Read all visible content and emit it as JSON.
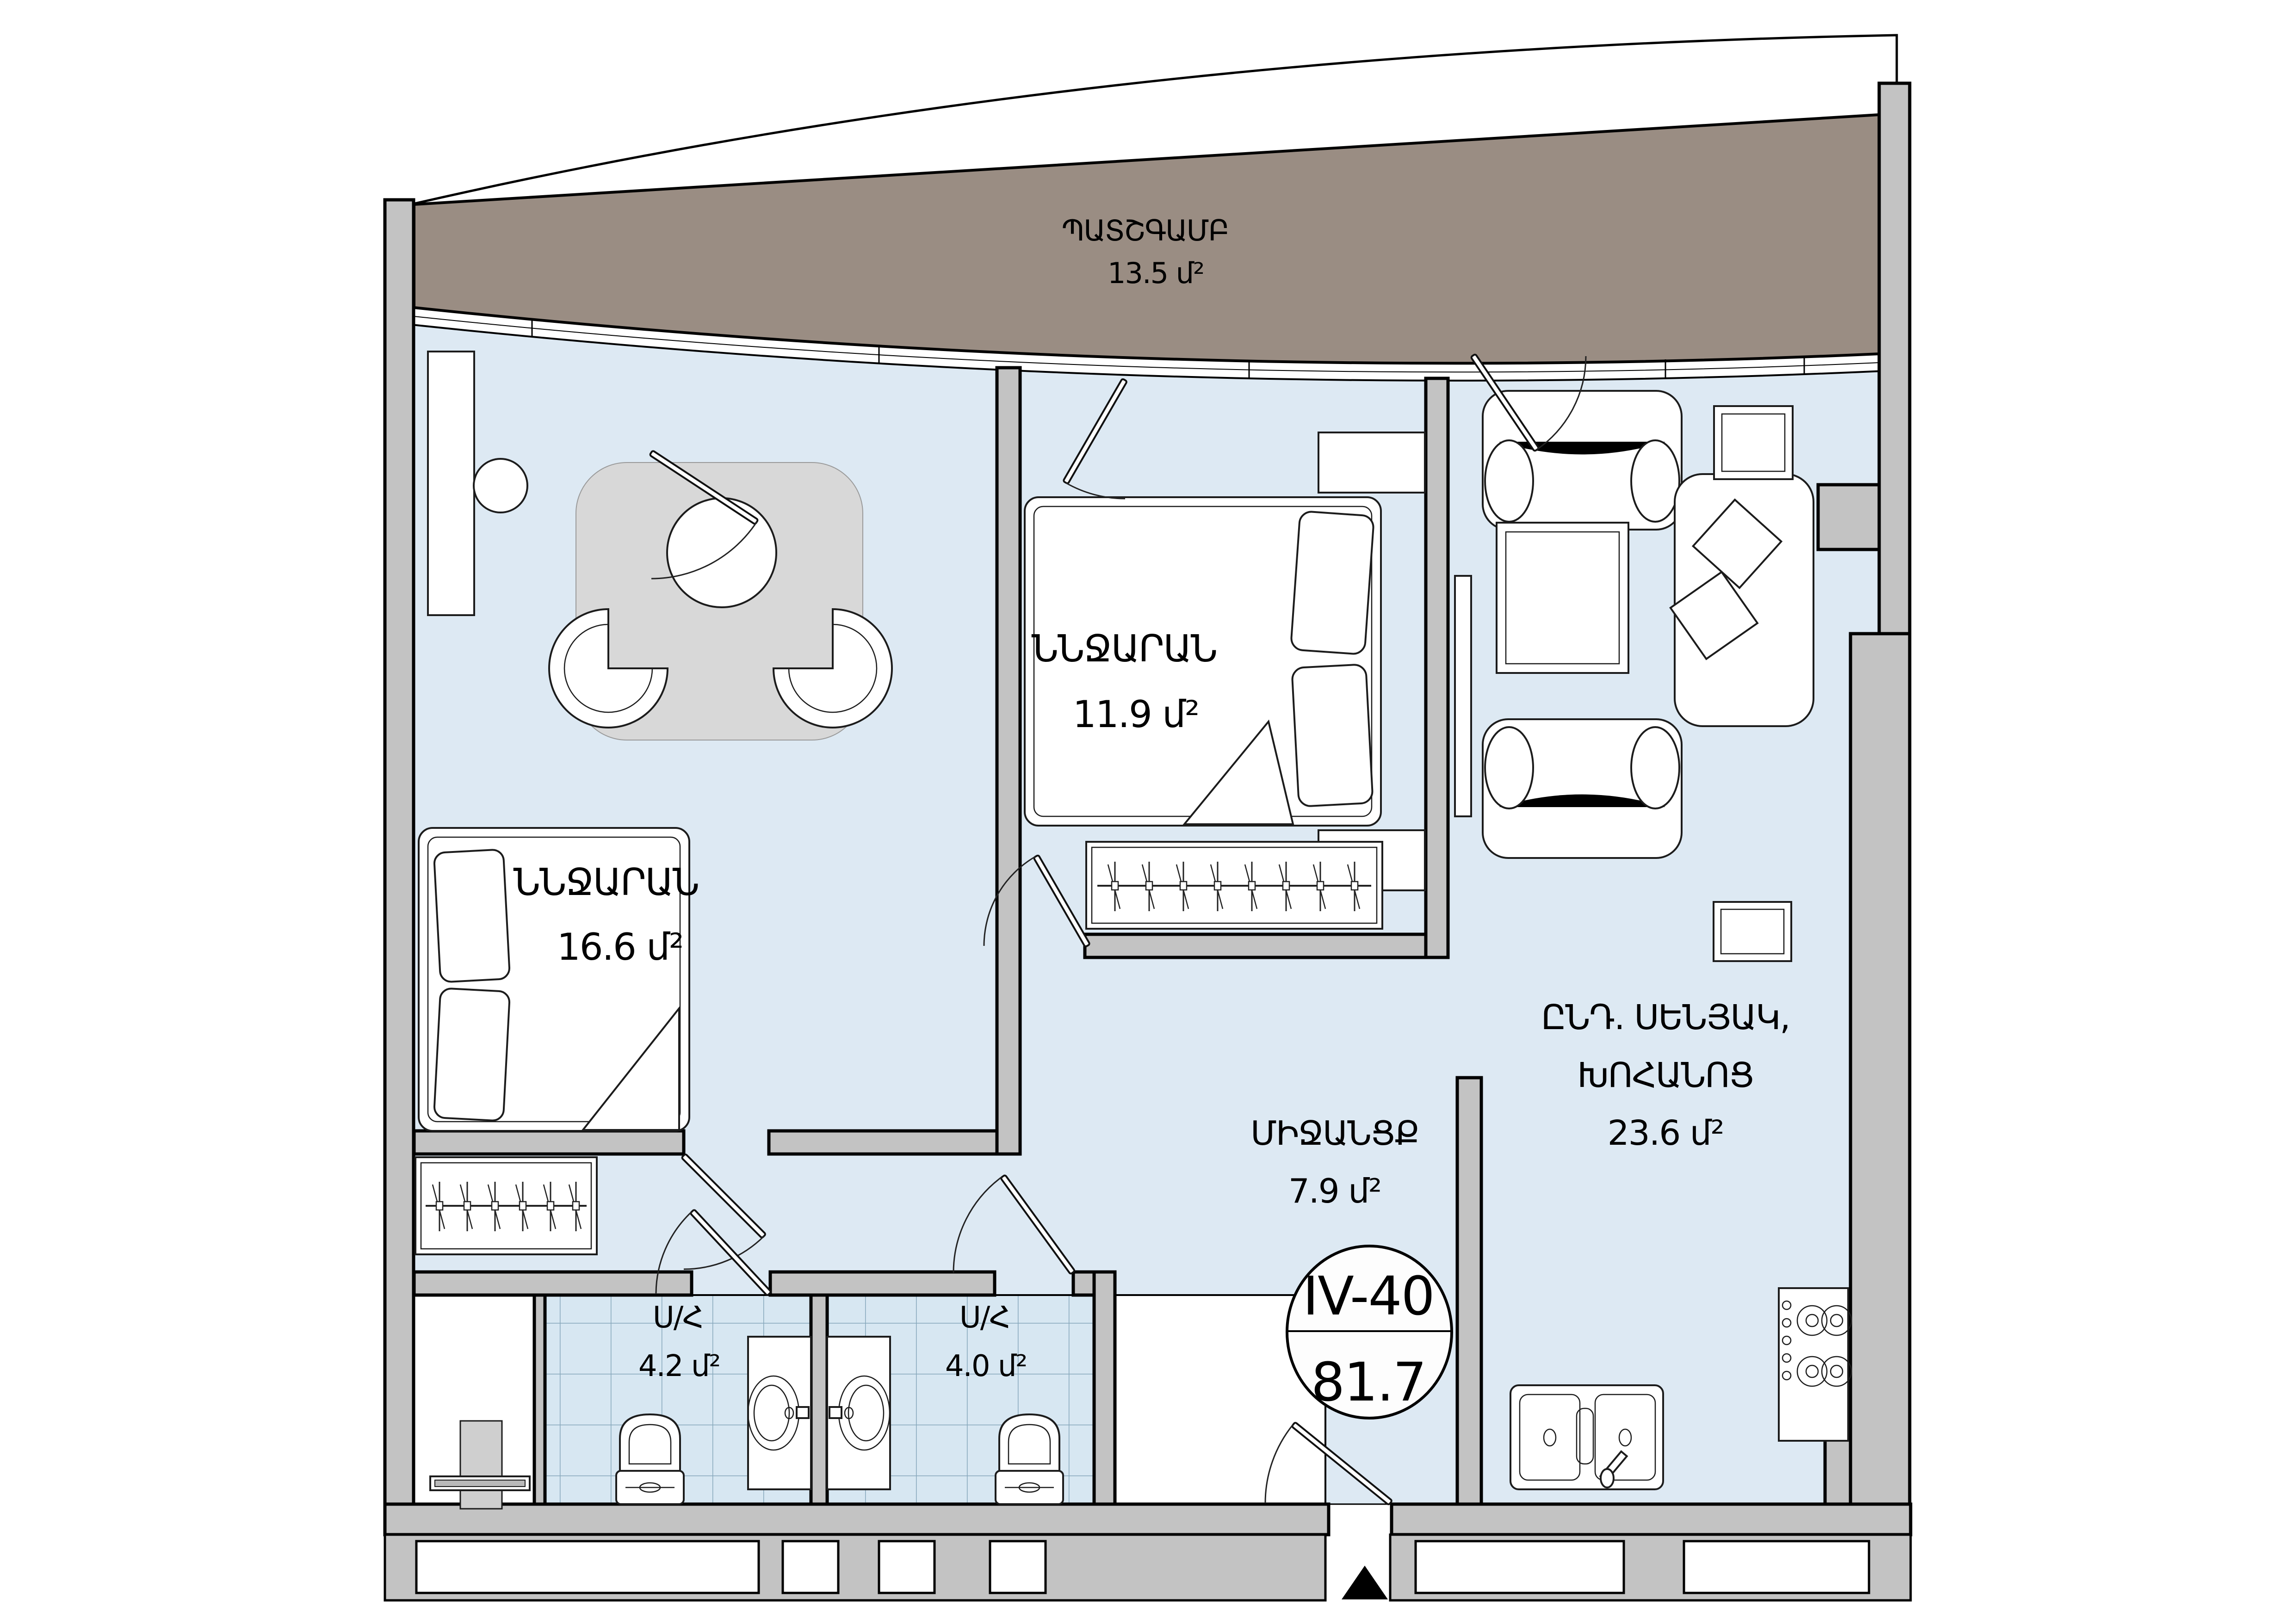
{
  "badge": {
    "unit": "IV-40",
    "area": "81.7"
  },
  "rooms": {
    "balcony": {
      "name": "ՊԱՏՇԳԱՄԲ",
      "area": "13.5 մ²"
    },
    "bedroom1": {
      "name": "ՆՆՋԱՐԱՆ",
      "area": "16.6 մ²"
    },
    "bedroom2": {
      "name": "ՆՆՋԱՐԱՆ",
      "area": "11.9 մ²"
    },
    "living": {
      "name_line1": "ԸՆԴ. ՍԵՆՅԱԿ,",
      "name_line2": "ԽՈՀԱՆՈՑ",
      "area": "23.6 մ²"
    },
    "hallway": {
      "name": "ՄԻՋԱՆՑՔ",
      "area": "7.9 մ²"
    },
    "bath1": {
      "name": "Ս/Հ",
      "area": "4.2 մ²"
    },
    "bath2": {
      "name": "Ս/Հ",
      "area": "4.0 մ²"
    }
  },
  "colors": {
    "balcony_floor": "#9a8d83",
    "room_floor": "#dde9f3",
    "tile_floor": "#d7e7f2",
    "tile_line": "#86a7bb",
    "wall": "#c3c3c3",
    "rug": "#d8d8d8",
    "appliance": "#cfcfcf",
    "line": "#000000"
  }
}
